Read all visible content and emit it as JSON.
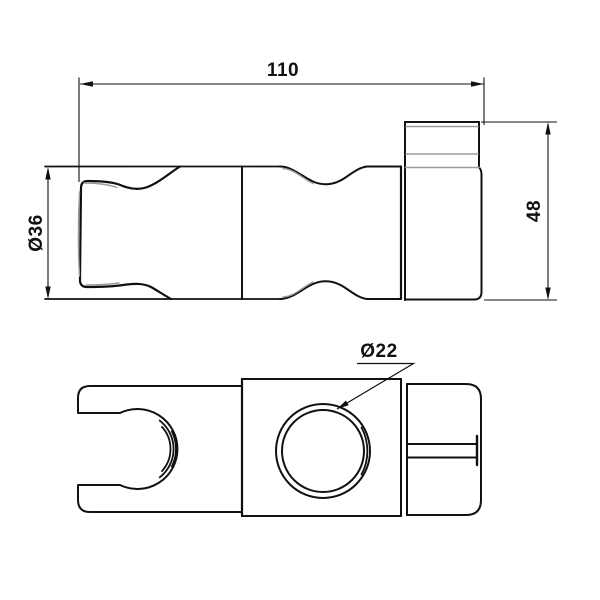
{
  "drawing": {
    "background_color": "#ffffff",
    "line_color": "#111111",
    "detail_line_color": "#9a9a9a",
    "views": [
      {
        "id": "side-view"
      },
      {
        "id": "front-view"
      }
    ],
    "dimensions": [
      {
        "id": "overall-length",
        "label": "110",
        "orientation": "horizontal"
      },
      {
        "id": "body-diameter",
        "label": "Ø36",
        "orientation": "vertical"
      },
      {
        "id": "end-height",
        "label": "48",
        "orientation": "vertical"
      },
      {
        "id": "hole-diameter",
        "label": "Ø22",
        "orientation": "leader"
      }
    ]
  }
}
